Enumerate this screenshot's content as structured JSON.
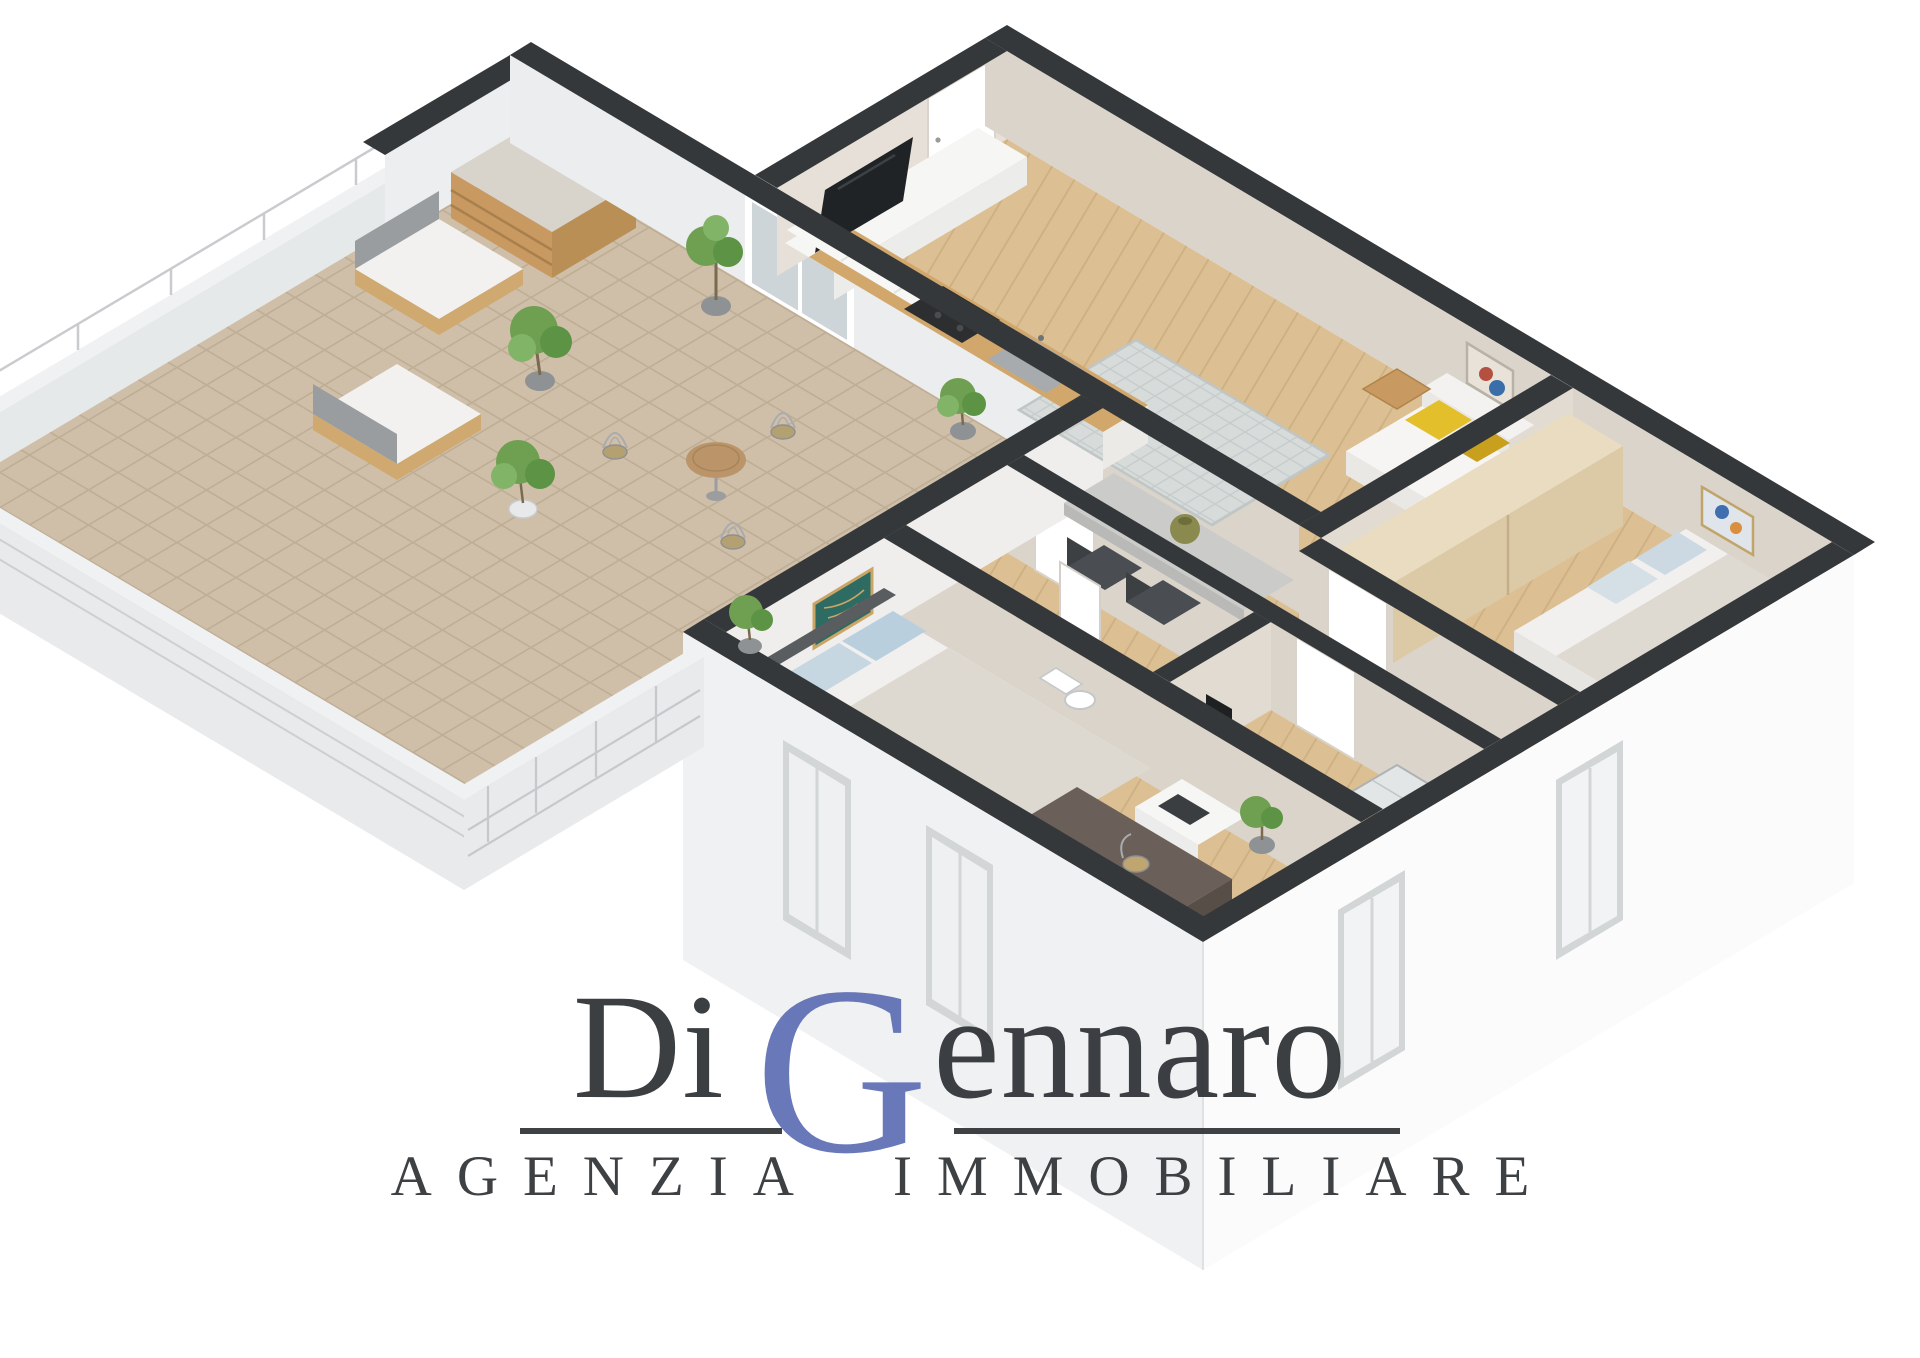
{
  "page": {
    "background": "#ffffff",
    "type": "3d-floorplan-render"
  },
  "brand": {
    "prefix": "Di",
    "initial": "G",
    "rest": "ennaro",
    "full_name": "Di Gennaro",
    "subtitle": "AGENZIA IMMOBILIARE",
    "accent_color": "#5566ae",
    "text_color": "#2e3134"
  },
  "palette": {
    "wall_top": "#35383a",
    "exterior_wall": "#fbfbfc",
    "exterior_wall_shaded": "#f0f1f3",
    "interior_wall_beige": "#dbd4ca",
    "interior_wall_light": "#eceae6",
    "wood_floor": "#dcbf93",
    "terrace_tile": "#cfbfa9",
    "counter_wood": "#d2a76b",
    "rug": "#d7dcdb",
    "sofa_white": "#f3f2f0",
    "pillow_yellow": "#e3bf2c",
    "pillow_blue": "#bdd1de",
    "wardrobe_wood": "#e9dcc0",
    "wardrobe_brown": "#6b6059",
    "plant_green": "#6fa052",
    "railing": "#c9ccce",
    "tv_black": "#202325",
    "art_teal": "#2e6b63"
  },
  "scene": {
    "rooms": [
      "terrace",
      "living-room-kitchen",
      "hallway",
      "bathroom",
      "storage-room",
      "bedroom-1",
      "bedroom-2"
    ],
    "furniture": [
      "kitchen-counter",
      "sink",
      "cooktop",
      "upper-cabinets",
      "tv",
      "media-unit",
      "sofa",
      "side-table",
      "dining-desk",
      "desk-chairs",
      "wardrobe",
      "single-bed",
      "double-bed",
      "dresser-printer",
      "brown-wardrobe",
      "shower",
      "outdoor-armchairs",
      "bistro-set",
      "wood-shelf",
      "potted-plants"
    ]
  }
}
